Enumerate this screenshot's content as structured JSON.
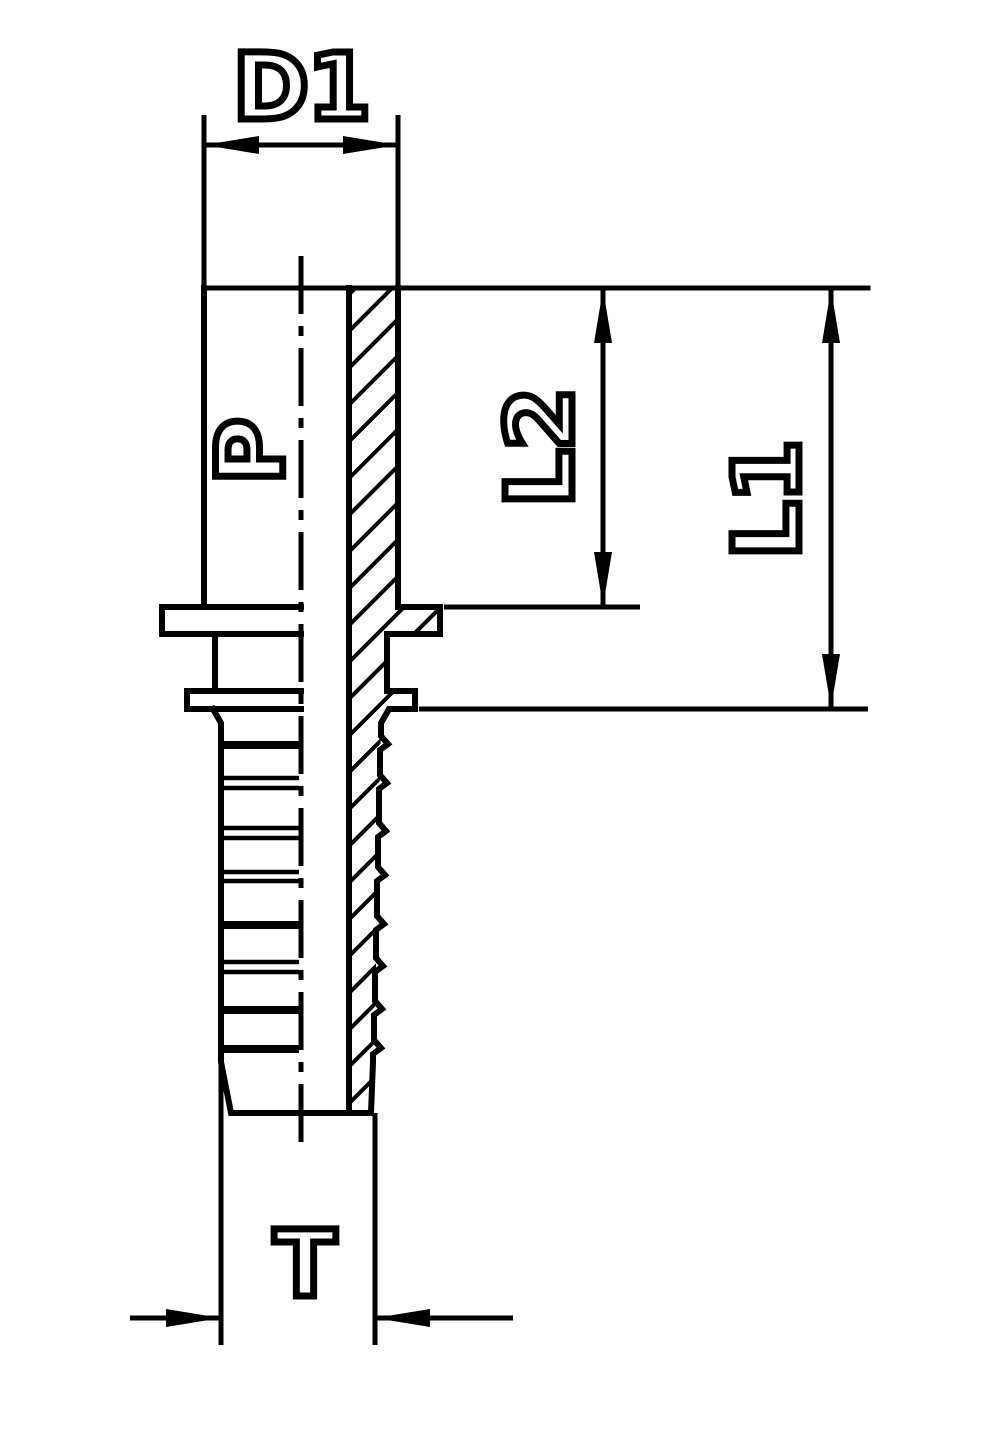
{
  "drawing": {
    "background": "#ffffff",
    "line_color": "#000000",
    "view": "hose-fitting-half-section",
    "dimensions": {
      "d1": {
        "label": "D1"
      },
      "l2": {
        "label": "L2"
      },
      "l1": {
        "label": "L1"
      },
      "t": {
        "label": "T"
      },
      "p": {
        "label": "P"
      }
    }
  }
}
